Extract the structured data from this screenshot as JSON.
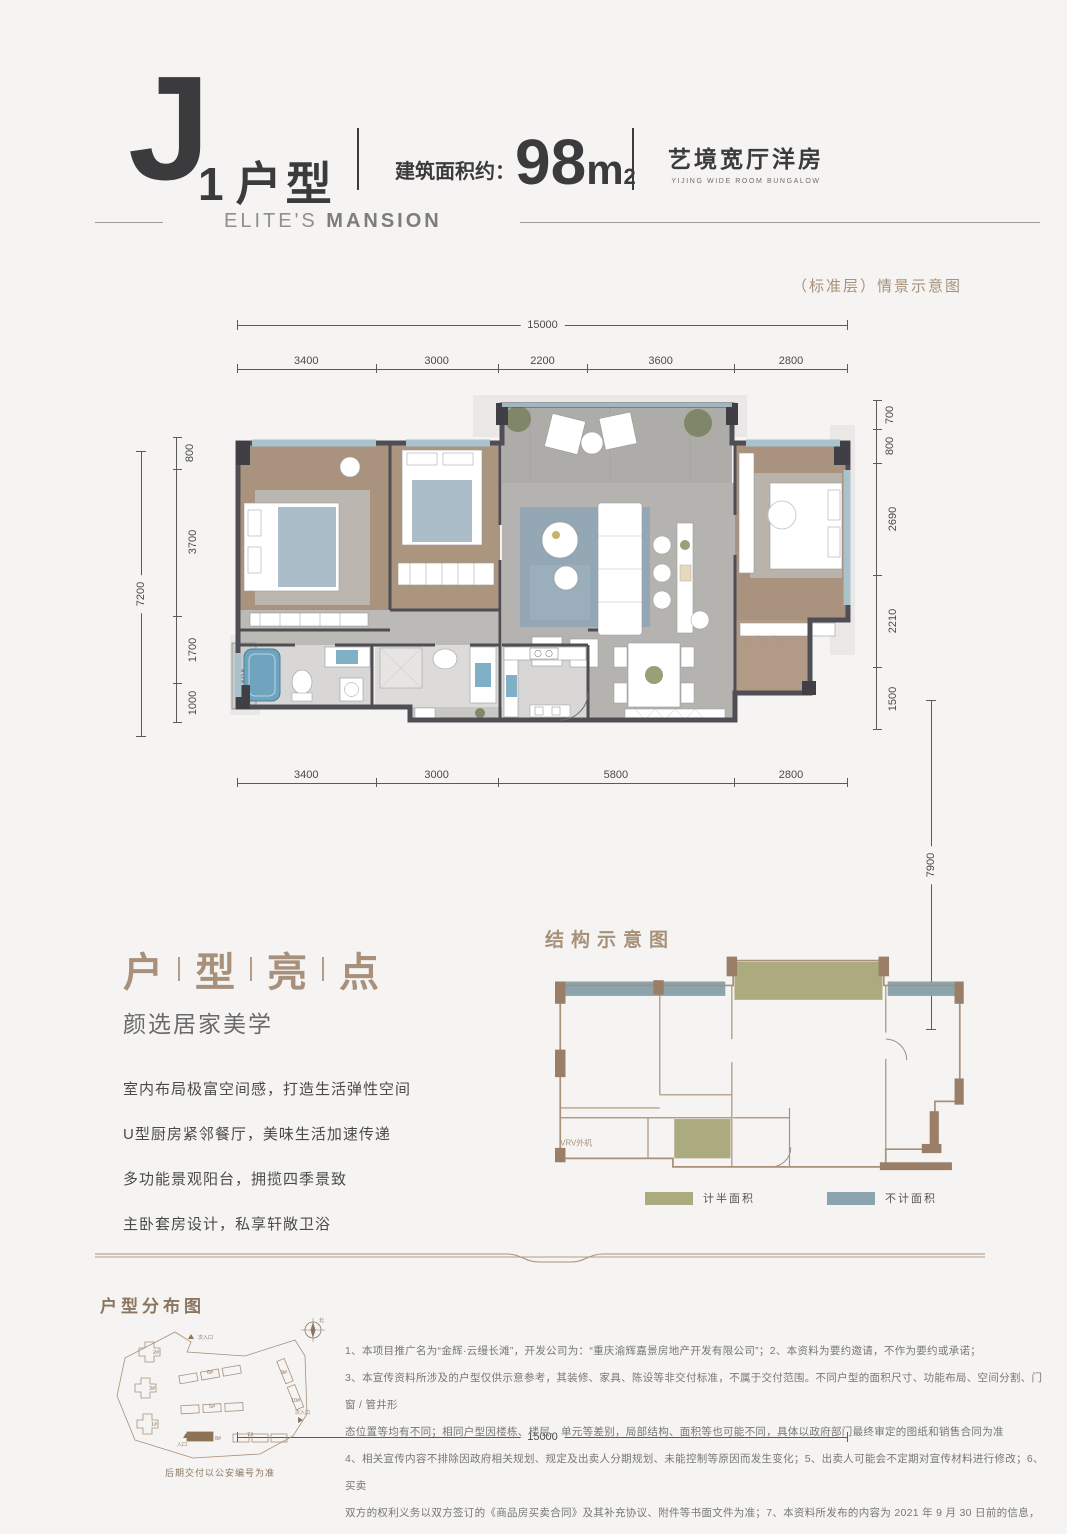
{
  "header": {
    "unit_letter": "J",
    "unit_number": "1",
    "unit_label": "户型",
    "area_label": "建筑面积约：",
    "area_value": "98",
    "area_unit": "m",
    "area_sup": "2",
    "product_name": "艺境宽厅洋房",
    "product_name_en": "YIJING WIDE ROOM BUNGALOW",
    "brand_light": "ELITE'S",
    "brand_bold": "MANSION"
  },
  "scene_note": "（标准层）情景示意图",
  "floorplan": {
    "top_total": "15000",
    "top_segments": [
      "3400",
      "3000",
      "2200",
      "3600",
      "2800"
    ],
    "bottom_segments": [
      "3400",
      "3000",
      "5800",
      "2800"
    ],
    "bottom_total": "15000",
    "left_total": "7200",
    "left_segments": [
      "800",
      "3700",
      "1700",
      "1000"
    ],
    "right_segments": [
      "700",
      "800",
      "2690",
      "2210",
      "1500"
    ],
    "right_total": "7900",
    "vrv_label": "VRV"
  },
  "highlights": {
    "title_chars": [
      "户",
      "型",
      "亮",
      "点"
    ],
    "subtitle": "颜选居家美学",
    "items": [
      "室内布局极富空间感，打造生活弹性空间",
      "U型厨房紧邻餐厅，美味生活加速传递",
      "多功能景观阳台，拥揽四季景致",
      "主卧套房设计，私享轩敞卫浴"
    ]
  },
  "structure": {
    "title": "结构示意图",
    "vrv_label": "VRV外机",
    "legend": [
      {
        "label": "计半面积",
        "color": "#acab80"
      },
      {
        "label": "不计面积",
        "color": "#8ba4ae"
      }
    ]
  },
  "siteplan": {
    "title": "户型分布图",
    "caption": "后期交付以公安编号为准",
    "north_label": "北",
    "entrance_main": "入口",
    "entrance_secondary_top": "次入口",
    "entrance_secondary_right": "次入口",
    "buildings": [
      "2#",
      "3#",
      "1#",
      "6#",
      "5#",
      "8#",
      "7#",
      "9#",
      "10#"
    ]
  },
  "disclaimer": {
    "lines": [
      "1、本项目推广名为“金辉·云缦长滩”，开发公司为：“重庆渝辉嘉景房地产开发有限公司”；2、本资料为要约邀请，不作为要约或承诺；",
      "3、本宣传资料所涉及的户型仅供示意参考，其装修、家具、陈设等非交付标准，不属于交付范围。不同户型的面积尺寸、功能布局、空间分割、门窗 / 管井形",
      "态位置等均有不同；相同户型因楼栋、楼层、单元等差别，局部结构、面积等也可能不同，具体以政府部门最终审定的图纸和销售合同为准",
      "4、相关宣传内容不排除因政府相关规划、规定及出卖人分期规划、未能控制等原因而发生变化；5、出卖人可能会不定期对宣传材料进行修改；6、买卖",
      "双方的权利义务以双方签订的《商品房买卖合同》及其补充协议、附件等书面文件为准；7、本资料所发布的内容为 2021 年 9 月 30 日前的信息，敬请留意最新资料。"
    ]
  },
  "colors": {
    "accent_tan": "#a8917b",
    "olive": "#acab80",
    "blue_gray": "#8ba4ae",
    "wall_dark": "#4e4e54"
  }
}
